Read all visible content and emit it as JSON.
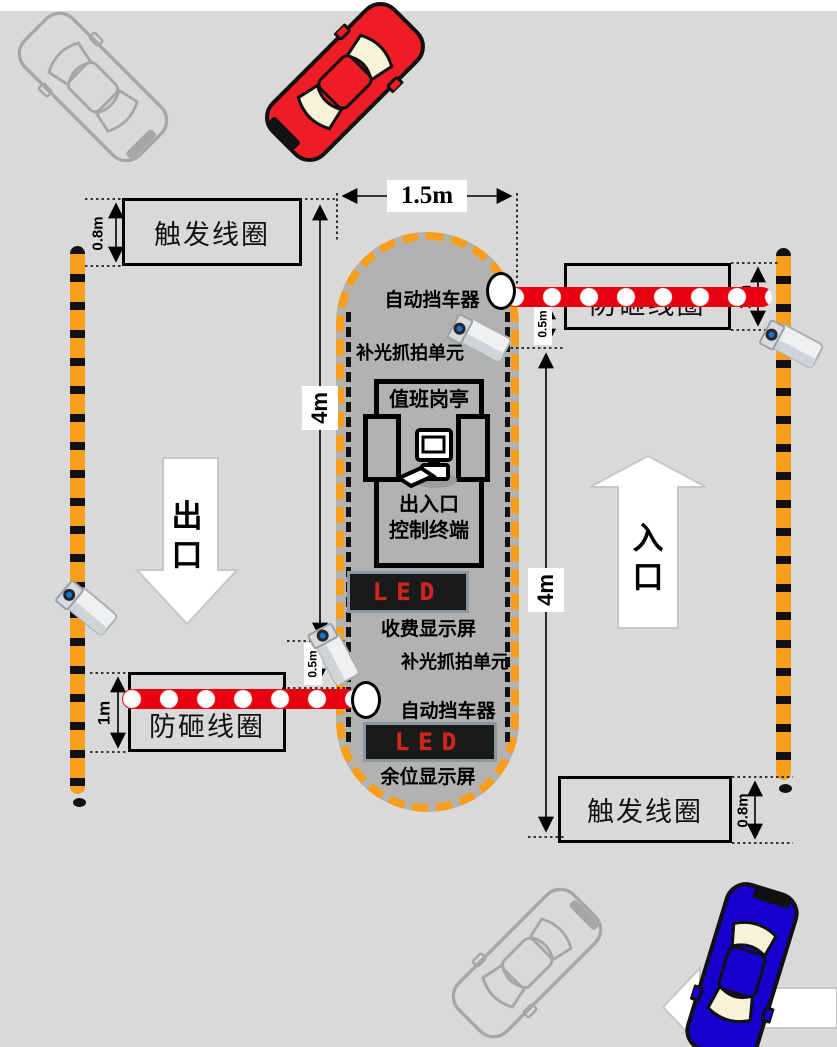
{
  "colors": {
    "background": "#d9d9d9",
    "road_line": "#ffffff",
    "island": "#b2b2b2",
    "island_border": "#f79e1d",
    "post_orange": "#f79e1d",
    "post_black": "#111111",
    "barrier_red": "#e80010",
    "barrier_white": "#ffffff",
    "led_bg": "#1a1a1a",
    "led_frame": "#8d989c",
    "led_text": "#cf271b",
    "arrow_fill": "#ffffff",
    "arrow_stroke": "#c6c6c6",
    "car_red": "#ee1c25",
    "car_blue": "#1500cd",
    "car_window": "#f7f3d8",
    "car_outline": "#a6a6a6"
  },
  "labels": {
    "trigger_coil_top": "触发线圈",
    "trigger_coil_bottom": "触发线圈",
    "anti_smash_coil_right": "防砸线圈",
    "anti_smash_coil_left": "防砸线圈",
    "auto_barrier_top": "自动挡车器",
    "auto_barrier_bottom": "自动挡车器",
    "capture_unit_top": "补光抓拍单元",
    "capture_unit_bottom": "补光抓拍单元",
    "duty_booth": "值班岗亭",
    "terminal_line1": "出入口",
    "terminal_line2": "控制终端",
    "fee_display": "收费显示屏",
    "vacancy_display": "余位显示屏",
    "led_top": "LED",
    "led_bottom": "LED",
    "exit": "出口",
    "entrance": "入口"
  },
  "dimensions": {
    "lane_width": "1.5m",
    "left_lane_length": "4m",
    "right_lane_length": "4m",
    "trigger_coil_top_depth": "0.8m",
    "trigger_coil_bottom_depth": "0.8m",
    "anti_smash_right_depth": "1m",
    "anti_smash_left_depth": "1m",
    "barrier_offset_right": "0.5m",
    "barrier_offset_left": "0.5m"
  }
}
